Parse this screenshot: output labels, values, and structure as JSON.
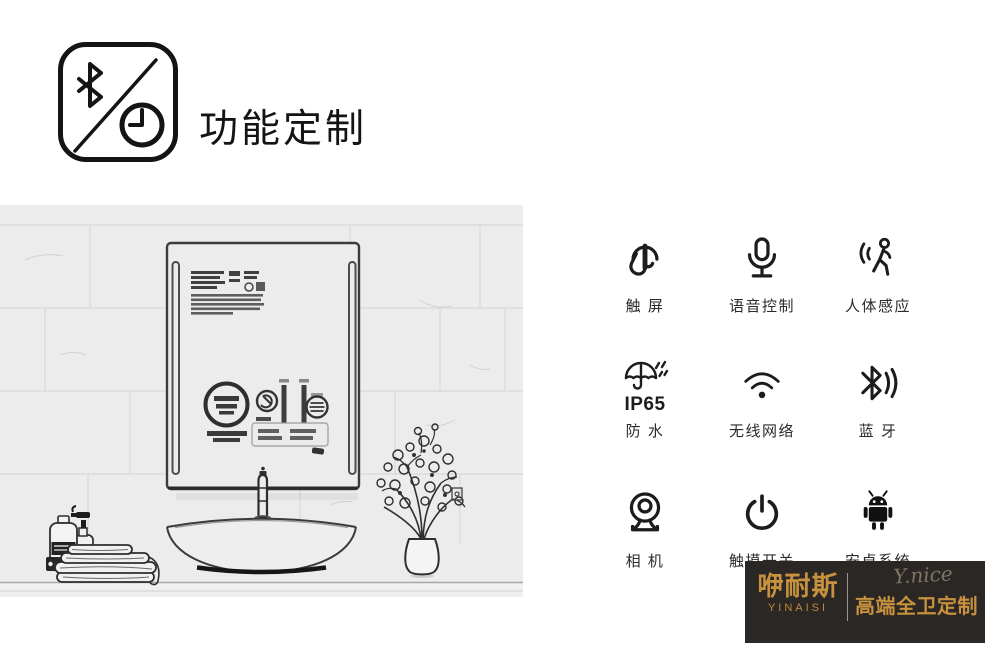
{
  "header": {
    "title": "功能定制"
  },
  "features": {
    "items": [
      {
        "name": "touch-screen",
        "label": "触 屏"
      },
      {
        "name": "voice-control",
        "label": "语音控制"
      },
      {
        "name": "human-sensor",
        "label": "人体感应"
      },
      {
        "name": "waterproof",
        "label": "防 水",
        "sub": "IP65"
      },
      {
        "name": "wifi",
        "label": "无线网络"
      },
      {
        "name": "bluetooth",
        "label": "蓝 牙"
      },
      {
        "name": "camera",
        "label": "相 机"
      },
      {
        "name": "touch-switch",
        "label": "触摸开关"
      },
      {
        "name": "android",
        "label": "安卓系统"
      }
    ]
  },
  "brand": {
    "name_cn": "咿耐斯",
    "name_en": "YINAISI",
    "script": "Y.nice",
    "tagline": "高端全卫定制"
  },
  "colors": {
    "gold": "#c7913e",
    "banner_bg": "#2a2725",
    "ink": "#1c1c1c",
    "sketch_bg": "#ececec"
  }
}
